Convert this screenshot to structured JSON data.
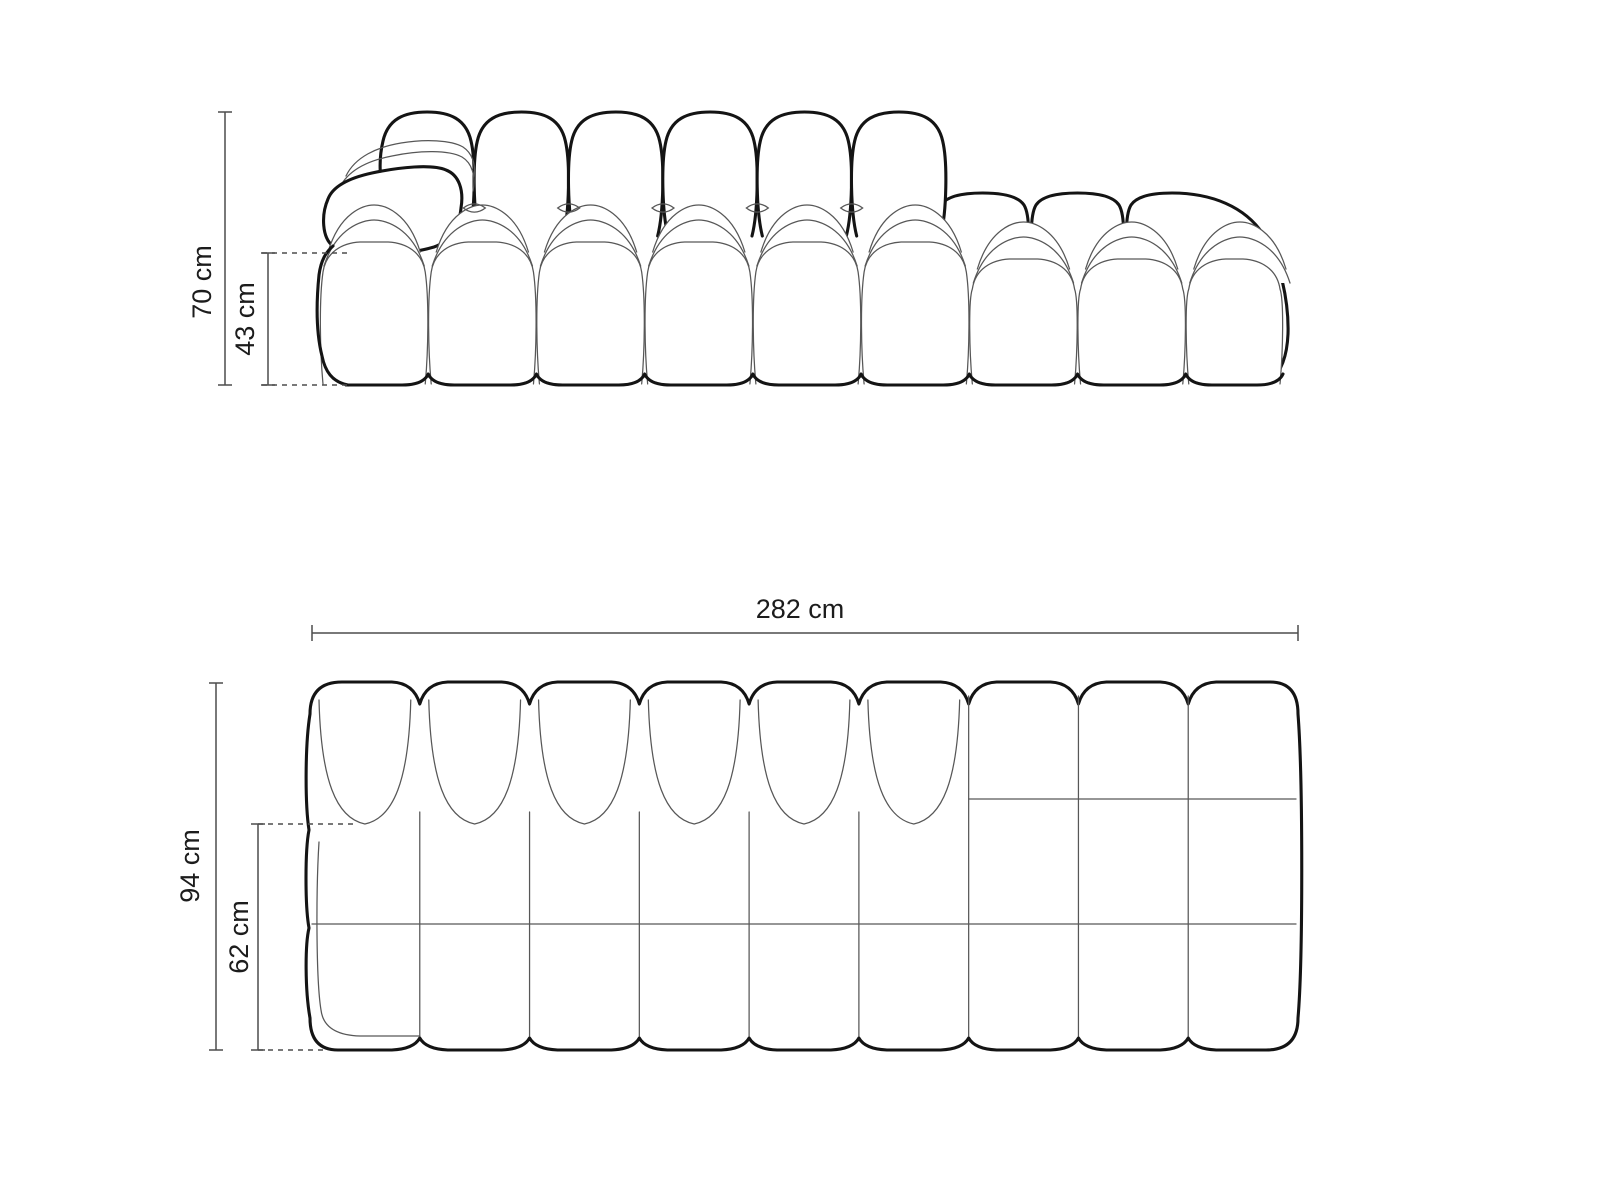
{
  "diagram": {
    "front_view": {
      "overall_height_label": "70 cm",
      "seat_height_label": "43 cm",
      "back_cushion_count": 6,
      "seat_module_count": 9
    },
    "top_view": {
      "overall_width_label": "282 cm",
      "overall_depth_label": "94 cm",
      "seat_depth_label": "62 cm",
      "module_column_count": 9,
      "back_cushion_count": 6
    },
    "colors": {
      "outline": "#141414",
      "thin_line": "#575757",
      "dimension_line": "#4d4d4d",
      "text": "#1c1c1c",
      "background": "#ffffff"
    }
  }
}
